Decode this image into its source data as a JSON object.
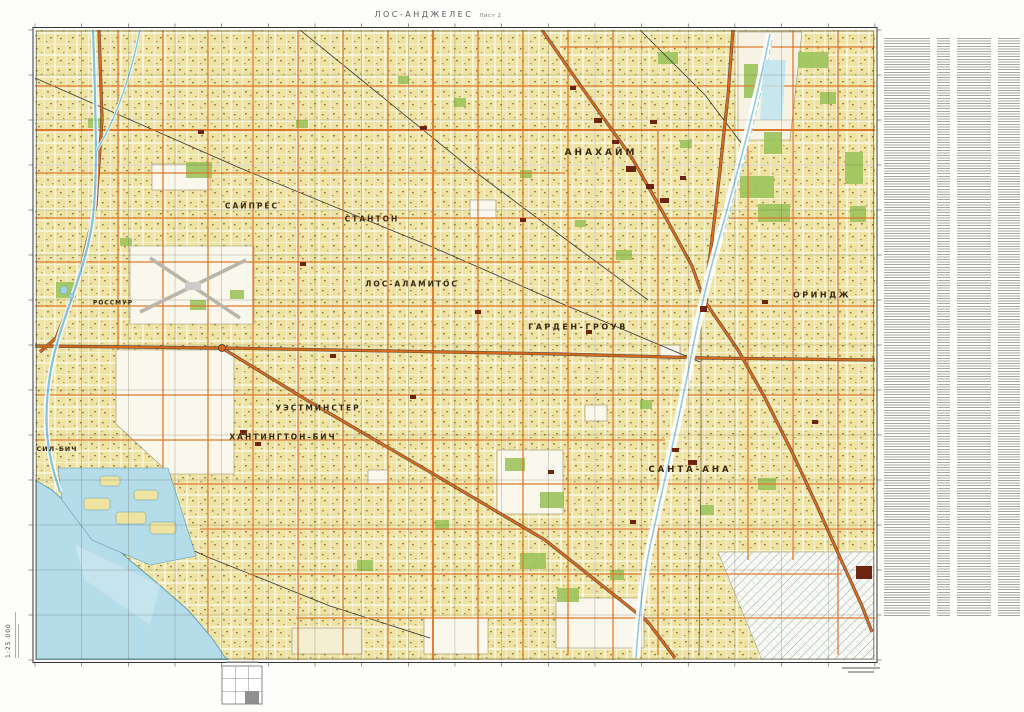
{
  "page": {
    "title": "ЛОС-АНДЖЕЛЕС",
    "sheet": "Лист 2"
  },
  "map": {
    "scale_label": "1:25 000",
    "city_labels": [
      {
        "id": "anaheim",
        "text": "АНАХАЙМ",
        "x": 601,
        "y": 153,
        "size": 9,
        "ls": 3
      },
      {
        "id": "cypress",
        "text": "САЙПРЕС",
        "x": 252,
        "y": 206,
        "size": 7.5,
        "ls": 2
      },
      {
        "id": "stanton",
        "text": "СТАНТОН",
        "x": 372,
        "y": 219,
        "size": 7.5,
        "ls": 2
      },
      {
        "id": "los-alamitos",
        "text": "ЛОС-АЛАМИТОС",
        "x": 412,
        "y": 284,
        "size": 7.5,
        "ls": 2
      },
      {
        "id": "garden-grove",
        "text": "ГАРДЕН-ГРОУВ",
        "x": 578,
        "y": 327,
        "size": 8,
        "ls": 2.5
      },
      {
        "id": "orange",
        "text": "ОРИНДЖ",
        "x": 822,
        "y": 295,
        "size": 8,
        "ls": 2.5
      },
      {
        "id": "westminster",
        "text": "УЭСТМИНСТЕР",
        "x": 318,
        "y": 408,
        "size": 7.5,
        "ls": 2
      },
      {
        "id": "huntington-beach",
        "text": "ХАНТИНГТОН-БИЧ",
        "x": 283,
        "y": 437,
        "size": 7.5,
        "ls": 2
      },
      {
        "id": "santa-ana",
        "text": "САНТА-АНА",
        "x": 690,
        "y": 470,
        "size": 8.5,
        "ls": 3
      },
      {
        "id": "seal-beach",
        "text": "СИЛ-БИЧ",
        "x": 57,
        "y": 449,
        "size": 6.5,
        "ls": 1
      },
      {
        "id": "rossmoor",
        "text": "РОССМУР",
        "x": 113,
        "y": 303,
        "size": 6,
        "ls": 1
      }
    ]
  },
  "colors": {
    "urban_fill": "#eee3a0",
    "ocean": "#b5dde9",
    "river": "#8fcadd",
    "park": "#9cc45c",
    "road_major": "#dd6a1c",
    "road_minor": "#dd7a30",
    "building": "#6d2412",
    "frame": "#333333"
  }
}
